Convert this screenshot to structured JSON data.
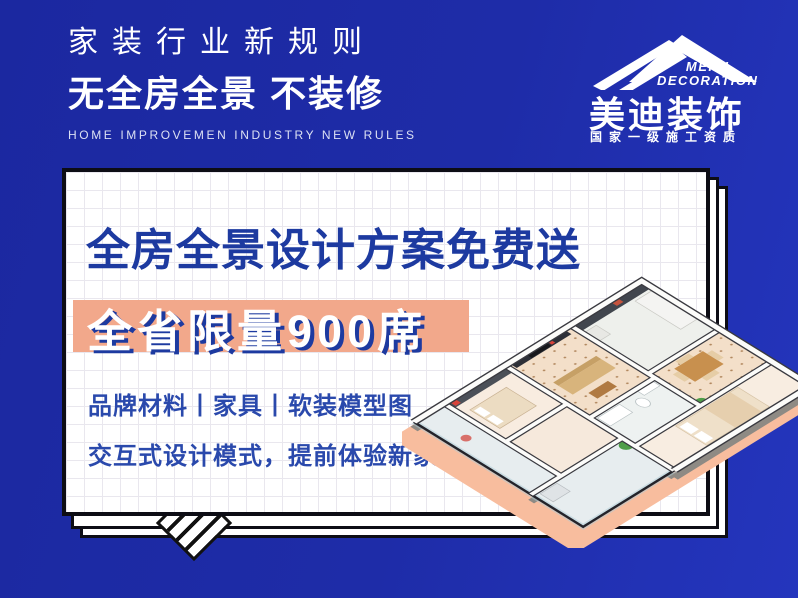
{
  "header": {
    "line1": "家装行业新规则",
    "line2": "无全房全景 不装修",
    "line3": "HOME IMPROVEMEN INDUSTRY NEW RULES"
  },
  "logo": {
    "en_line1": "MEIDI",
    "en_line2": "DECORATION",
    "name_cn": "美迪装饰",
    "qualification": "国家一级施工资质"
  },
  "card": {
    "title": "全房全景设计方案免费送",
    "banner": "全省限量900席",
    "line1": "品牌材料丨家具丨软装模型图",
    "line2": "交互式设计模式，提前体验新家"
  },
  "colors": {
    "background_blue": "#1e2ca8",
    "title_navy": "#1d3aa0",
    "banner_salmon": "#f2a88b",
    "banner_text_shadow": "#1d3aa0",
    "body_text": "#2a49ac",
    "plan_shadow_peach": "#f8bd9e",
    "card_border": "#0d0d15"
  },
  "icons": {
    "roof_logo": "mountain-roof-mark",
    "floorplan": "isometric-3d-apartment-floorplan"
  }
}
